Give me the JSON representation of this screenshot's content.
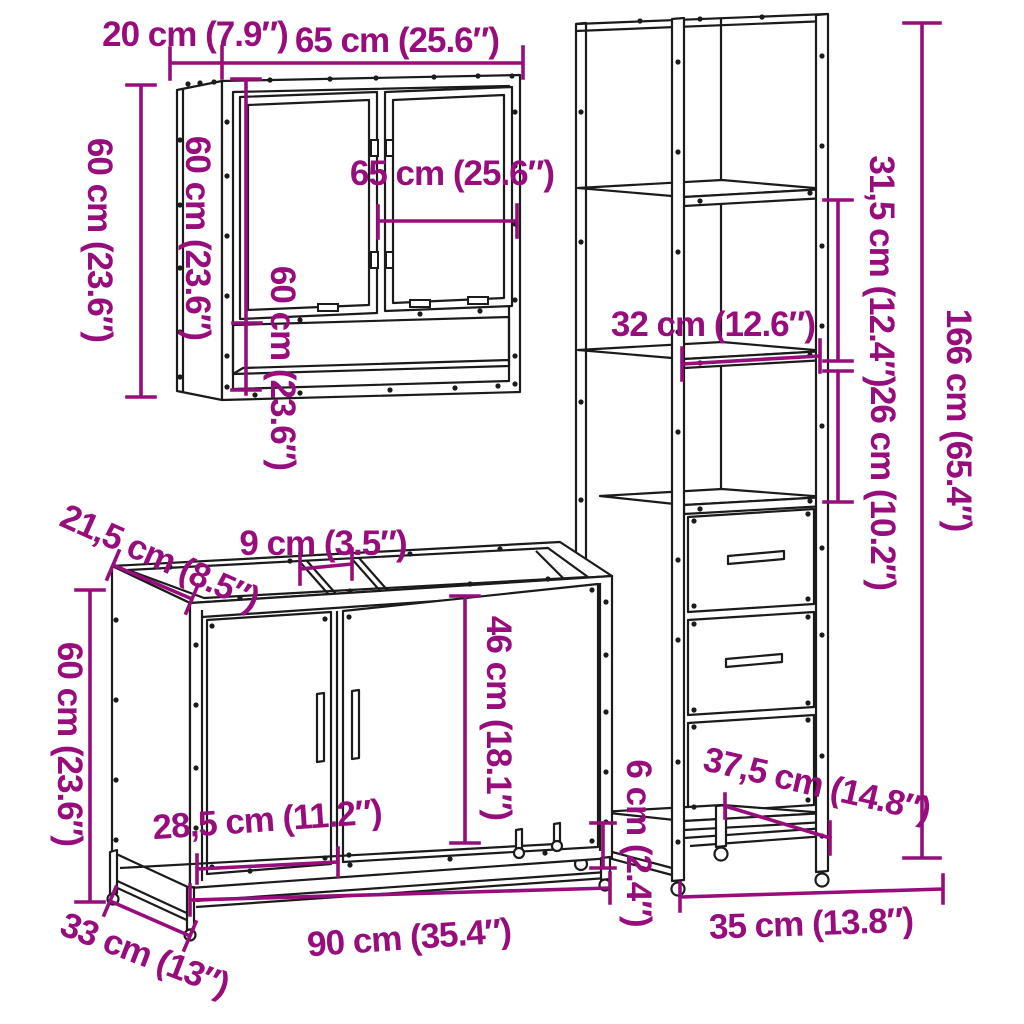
{
  "diagram": {
    "type": "furniture-dimension-diagram",
    "pieces": [
      "wall mirror cabinet",
      "tall storage cabinet",
      "sink vanity cabinet"
    ],
    "colors": {
      "dimension": "#970d7c",
      "outline": "#1b1b1b",
      "background": "#ffffff"
    },
    "labels": {
      "mirror_depth": "20 cm (7.9″)",
      "mirror_width": "65 cm (25.6″)",
      "mirror_height": "60 cm (23.6″)",
      "mirror_height_side": "60 cm (23.6″)",
      "mirror_height_inner": "60 cm (23.6″)",
      "mirror_width_inner": "65 cm (25.6″)",
      "tall_upper_shelf_gap": "31,5 cm (12.4″)",
      "tall_lower_shelf_gap": "26 cm (10.2″)",
      "tall_height": "166 cm (65.4″)",
      "tall_shelf_width": "32 cm (12.6″)",
      "vanity_top_depth": "21,5 cm (8.5″)",
      "vanity_top_gap": "9 cm (3.5″)",
      "vanity_door_height": "46 cm (18.1″)",
      "vanity_height": "60 cm (23.6″)",
      "vanity_door_width": "28,5 cm (11.2″)",
      "tall_ground_clearance": "6 cm (2.4″)",
      "tall_base_diagonal": "37,5 cm (14.8″)",
      "vanity_base_depth": "33 cm (13″)",
      "vanity_width": "90 cm (35.4″)",
      "tall_width": "35 cm (13.8″)"
    }
  }
}
